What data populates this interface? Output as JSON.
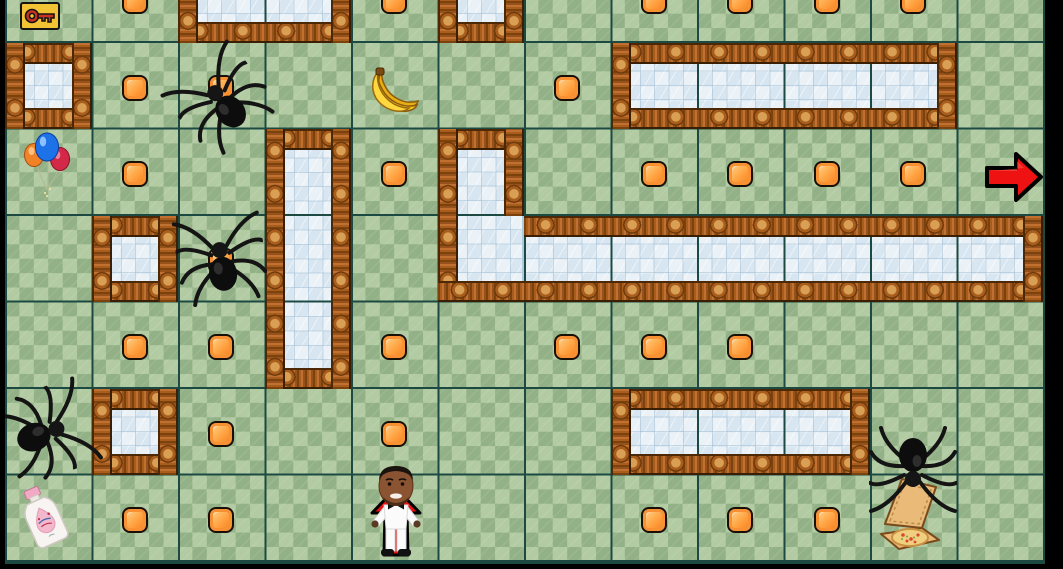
{
  "app": {
    "title": "Tile maze grid game",
    "background": "#000000"
  },
  "hud": {
    "collected_item": "key-icon"
  },
  "board": {
    "cols": 12,
    "rows": 7,
    "colors": {
      "grass_light": "#b2cba3",
      "grass_dark": "#93b187",
      "gridline": "#1c4a42",
      "ice_light": "#eaf2f8",
      "ice_dark": "#d7e6f0",
      "fence_wood": "#a85d1c",
      "coin_orange": "#ff9e3d",
      "arrow_red": "#ee1212",
      "hud_key_bg": "#f2c335",
      "key_red": "#c83222",
      "balloon_blue": "#1e72e8",
      "balloon_orange": "#f08228",
      "balloon_red": "#d42848",
      "banana_yellow": "#f6c51c",
      "pizza_box_tan": "#e9ba78",
      "bottle_pink": "#f3b8cb"
    },
    "ice_regions": [
      {
        "col": 2,
        "row": 0,
        "w": 2,
        "h": 1,
        "fences": [
          "top",
          "bottom",
          "left",
          "right"
        ]
      },
      {
        "col": 5,
        "row": 0,
        "w": 1,
        "h": 1,
        "fences": [
          "top",
          "bottom",
          "left",
          "right"
        ]
      },
      {
        "col": 0,
        "row": 1,
        "w": 1,
        "h": 1,
        "fences": [
          "top",
          "bottom",
          "left",
          "right"
        ]
      },
      {
        "col": 7,
        "row": 1,
        "w": 4,
        "h": 1,
        "fences": [
          "top",
          "bottom",
          "left",
          "right"
        ]
      },
      {
        "col": 3,
        "row": 2,
        "w": 1,
        "h": 3,
        "fences": [
          "top",
          "bottom",
          "left",
          "right"
        ]
      },
      {
        "col": 5,
        "row": 2,
        "w": 1,
        "h": 2,
        "fences": [
          "top",
          "left",
          "bottom"
        ]
      },
      {
        "col": 6,
        "row": 3,
        "w": 6,
        "h": 1,
        "fences": [
          "top",
          "bottom",
          "right"
        ]
      },
      {
        "col": 1,
        "row": 3,
        "w": 1,
        "h": 1,
        "fences": [
          "top",
          "bottom",
          "left",
          "right"
        ]
      },
      {
        "col": 1,
        "row": 5,
        "w": 1,
        "h": 1,
        "fences": [
          "top",
          "bottom",
          "left",
          "right"
        ]
      },
      {
        "col": 7,
        "row": 5,
        "w": 3,
        "h": 1,
        "fences": [
          "top",
          "bottom",
          "left",
          "right"
        ]
      }
    ],
    "extra_fences": [
      {
        "col": 6,
        "row": 2,
        "len": 1,
        "dir": "v",
        "inside": "left"
      }
    ],
    "items": [
      {
        "type": "coin",
        "col": 1,
        "row": 0
      },
      {
        "type": "coin",
        "col": 4,
        "row": 0
      },
      {
        "type": "coin",
        "col": 7,
        "row": 0
      },
      {
        "type": "coin",
        "col": 8,
        "row": 0
      },
      {
        "type": "coin",
        "col": 9,
        "row": 0
      },
      {
        "type": "coin",
        "col": 10,
        "row": 0
      },
      {
        "type": "coin",
        "col": 1,
        "row": 1
      },
      {
        "type": "coin",
        "col": 2,
        "row": 1
      },
      {
        "type": "coin",
        "col": 6,
        "row": 1
      },
      {
        "type": "banana",
        "col": 4,
        "row": 1,
        "dy": 5
      },
      {
        "type": "spider",
        "col": 2,
        "row": 1,
        "rot": -40,
        "dy": 14
      },
      {
        "type": "balloons",
        "col": 0,
        "row": 2,
        "dy": -7
      },
      {
        "type": "coin",
        "col": 1,
        "row": 2
      },
      {
        "type": "coin",
        "col": 4,
        "row": 2
      },
      {
        "type": "coin",
        "col": 7,
        "row": 2
      },
      {
        "type": "coin",
        "col": 8,
        "row": 2
      },
      {
        "type": "coin",
        "col": 9,
        "row": 2
      },
      {
        "type": "coin",
        "col": 10,
        "row": 2
      },
      {
        "type": "arrow_right",
        "col": 11,
        "row": 2,
        "dx": 14,
        "dy": 5
      },
      {
        "type": "coin",
        "col": 2,
        "row": 3
      },
      {
        "type": "spider",
        "col": 2,
        "row": 3,
        "rot": -8
      },
      {
        "type": "coin",
        "col": 1,
        "row": 4
      },
      {
        "type": "coin",
        "col": 2,
        "row": 4
      },
      {
        "type": "coin",
        "col": 4,
        "row": 4
      },
      {
        "type": "coin",
        "col": 6,
        "row": 4
      },
      {
        "type": "coin",
        "col": 7,
        "row": 4
      },
      {
        "type": "coin",
        "col": 8,
        "row": 4
      },
      {
        "type": "spider",
        "col": 0,
        "row": 5,
        "rot": 70
      },
      {
        "type": "coin",
        "col": 2,
        "row": 5
      },
      {
        "type": "coin",
        "col": 4,
        "row": 5
      },
      {
        "type": "spider",
        "col": 10,
        "row": 5,
        "rot": 180,
        "dy": 38
      },
      {
        "type": "bottle",
        "col": 0,
        "row": 6,
        "dx": -4
      },
      {
        "type": "coin",
        "col": 1,
        "row": 6
      },
      {
        "type": "coin",
        "col": 2,
        "row": 6
      },
      {
        "type": "player",
        "col": 4,
        "row": 6,
        "dx": 2,
        "dy": -7
      },
      {
        "type": "coin",
        "col": 7,
        "row": 6
      },
      {
        "type": "coin",
        "col": 8,
        "row": 6
      },
      {
        "type": "coin",
        "col": 9,
        "row": 6
      },
      {
        "type": "pizza",
        "col": 10,
        "row": 6,
        "dx": -3
      }
    ]
  }
}
